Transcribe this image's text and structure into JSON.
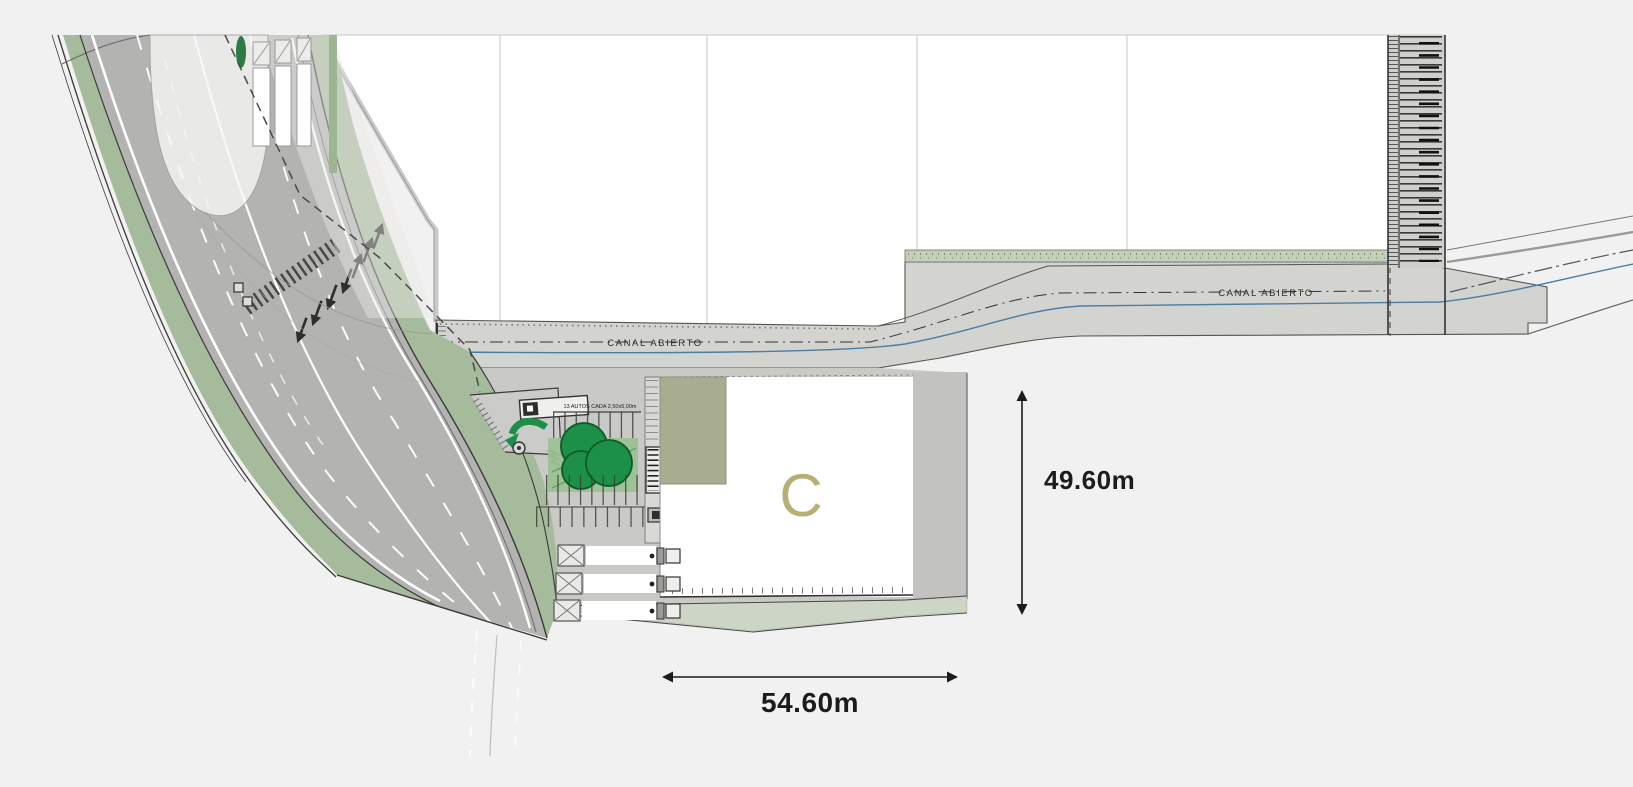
{
  "plan": {
    "canal": {
      "label_left": "CANAL ABIERTO",
      "label_right": "CANAL ABIERTO"
    },
    "building": {
      "label": "C"
    },
    "dimensions": {
      "vertical": "49.60m",
      "horizontal": "54.60m"
    },
    "parking": {
      "note": "13 AUTOS CADA 2,50x5,00m"
    },
    "colors": {
      "background": "#f2f1f1",
      "road": "#b3b3b1",
      "verge_green": "#a6bb9b",
      "tree_green": "#1d9048",
      "canal_gray": "#d3d3d0",
      "water_blue": "#4a7fa5",
      "site_gray": "#c9c9c6",
      "pad_annex_olive": "#a8ac91",
      "building_letter": "#b6b173",
      "dimension_text": "#1c1c1e"
    }
  }
}
